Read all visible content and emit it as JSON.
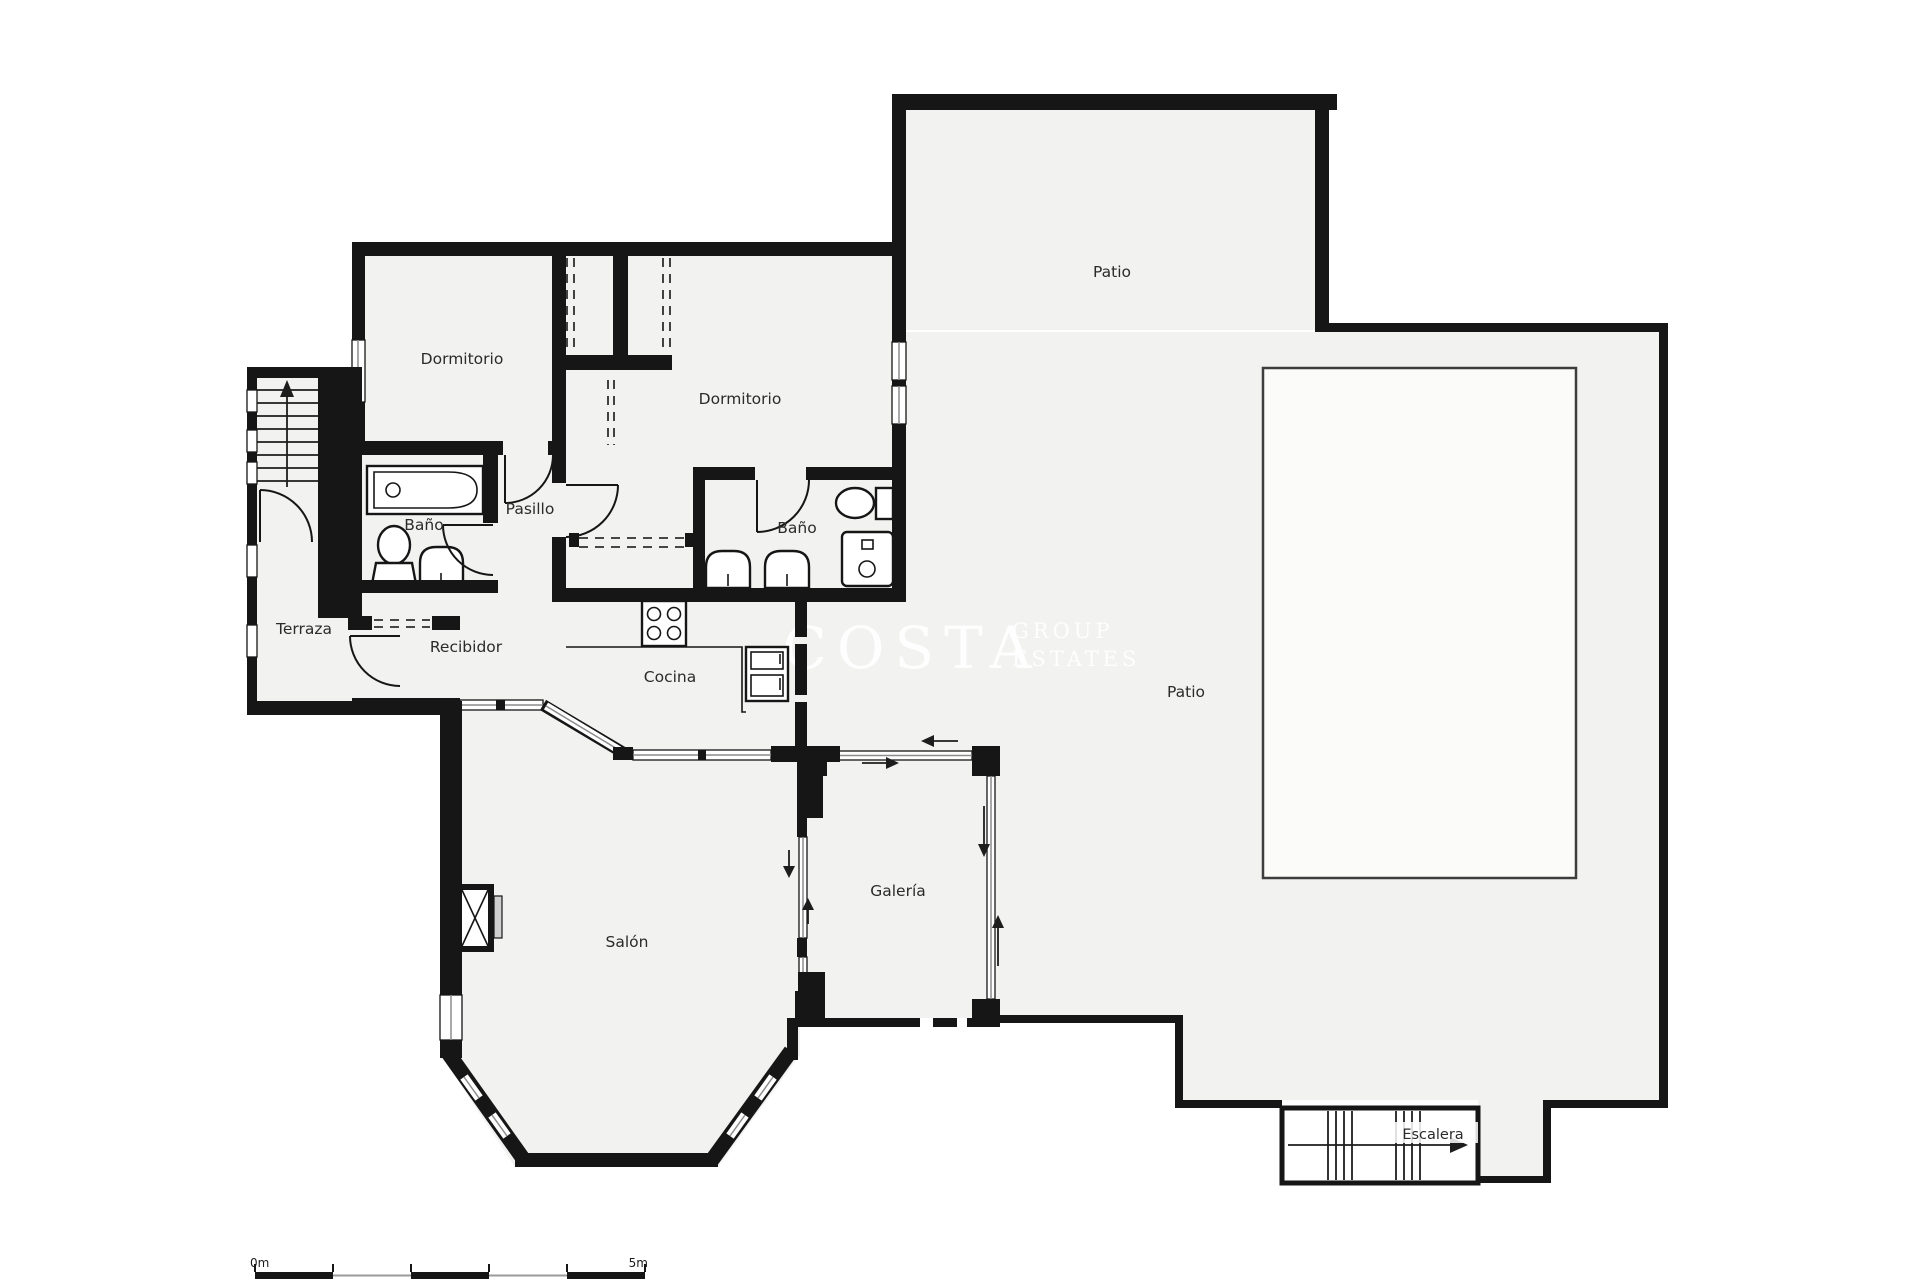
{
  "rooms": {
    "patio_top": {
      "label": "Patio"
    },
    "patio_main": {
      "label": "Patio"
    },
    "dormitorio_left": {
      "label": "Dormitorio"
    },
    "dormitorio_right": {
      "label": "Dormitorio"
    },
    "bano_left": {
      "label": "Baño"
    },
    "bano_right": {
      "label": "Baño"
    },
    "pasillo": {
      "label": "Pasillo"
    },
    "terraza": {
      "label": "Terraza"
    },
    "recibidor": {
      "label": "Recibidor"
    },
    "cocina": {
      "label": "Cocina"
    },
    "salon": {
      "label": "Salón"
    },
    "galeria": {
      "label": "Galería"
    },
    "escalera": {
      "label": "Escalera"
    }
  },
  "scale_bar": {
    "start_label": "0m",
    "end_label": "5m"
  },
  "watermark": {
    "primary": "COSTA",
    "secondary": "GROUP",
    "tertiary": "ESTATES"
  },
  "colors": {
    "ink": "#161616",
    "floor": "#f2f2f1",
    "outside": "#ffffff",
    "glass": "#8c8c8c",
    "pool_border": "#3d3d3d"
  }
}
